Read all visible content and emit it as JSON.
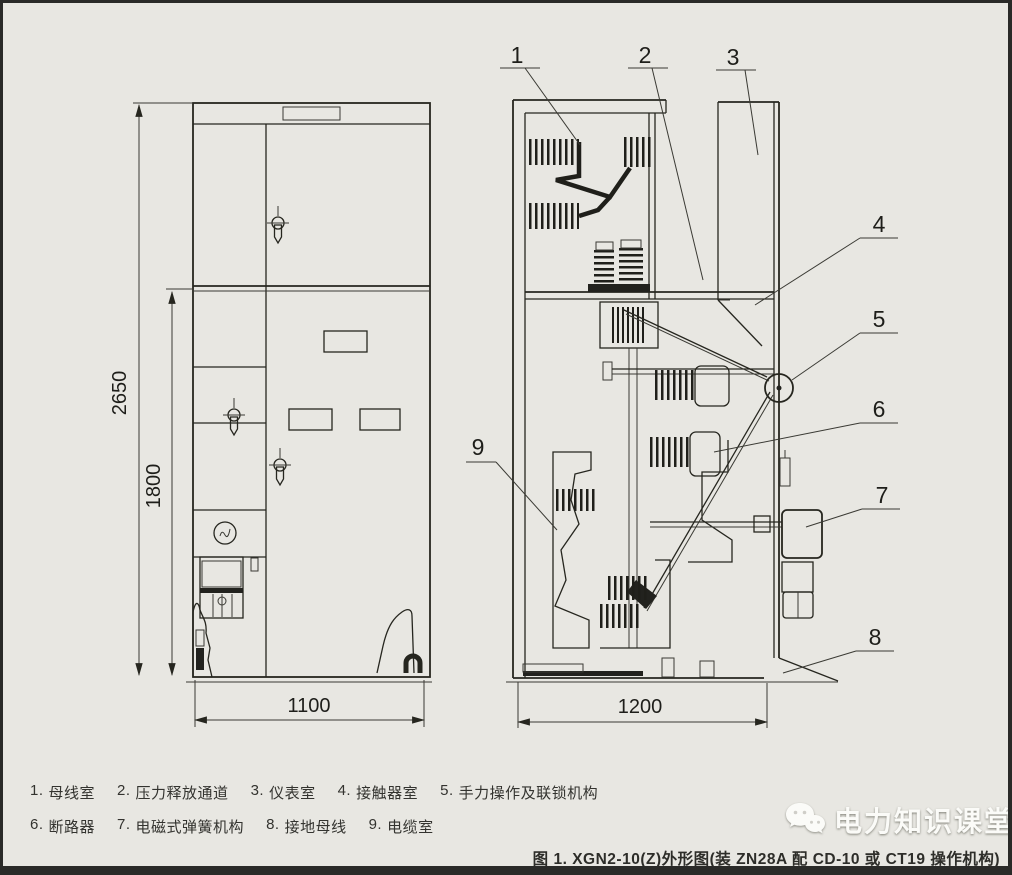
{
  "drawing": {
    "callouts": [
      "1",
      "2",
      "3",
      "4",
      "5",
      "6",
      "7",
      "8",
      "9"
    ],
    "dimensions": {
      "total_height": "2650",
      "body_height": "1800",
      "front_width": "1100",
      "side_depth": "1200"
    }
  },
  "legend": {
    "rows": [
      [
        {
          "num": "1.",
          "label": "母线室"
        },
        {
          "num": "2.",
          "label": "压力释放通道"
        },
        {
          "num": "3.",
          "label": "仪表室"
        },
        {
          "num": "4.",
          "label": "接触器室"
        },
        {
          "num": "5.",
          "label": "手力操作及联锁机构"
        }
      ],
      [
        {
          "num": "6.",
          "label": "断路器"
        },
        {
          "num": "7.",
          "label": "电磁式弹簧机构"
        },
        {
          "num": "8.",
          "label": "接地母线"
        },
        {
          "num": "9.",
          "label": "电缆室"
        }
      ]
    ]
  },
  "caption": "图 1. XGN2-10(Z)外形图(装 ZN28A 配 CD-10 或 CT19 操作机构)",
  "watermark": {
    "brand": "电力知识课堂",
    "icon": "wechat-icon"
  }
}
